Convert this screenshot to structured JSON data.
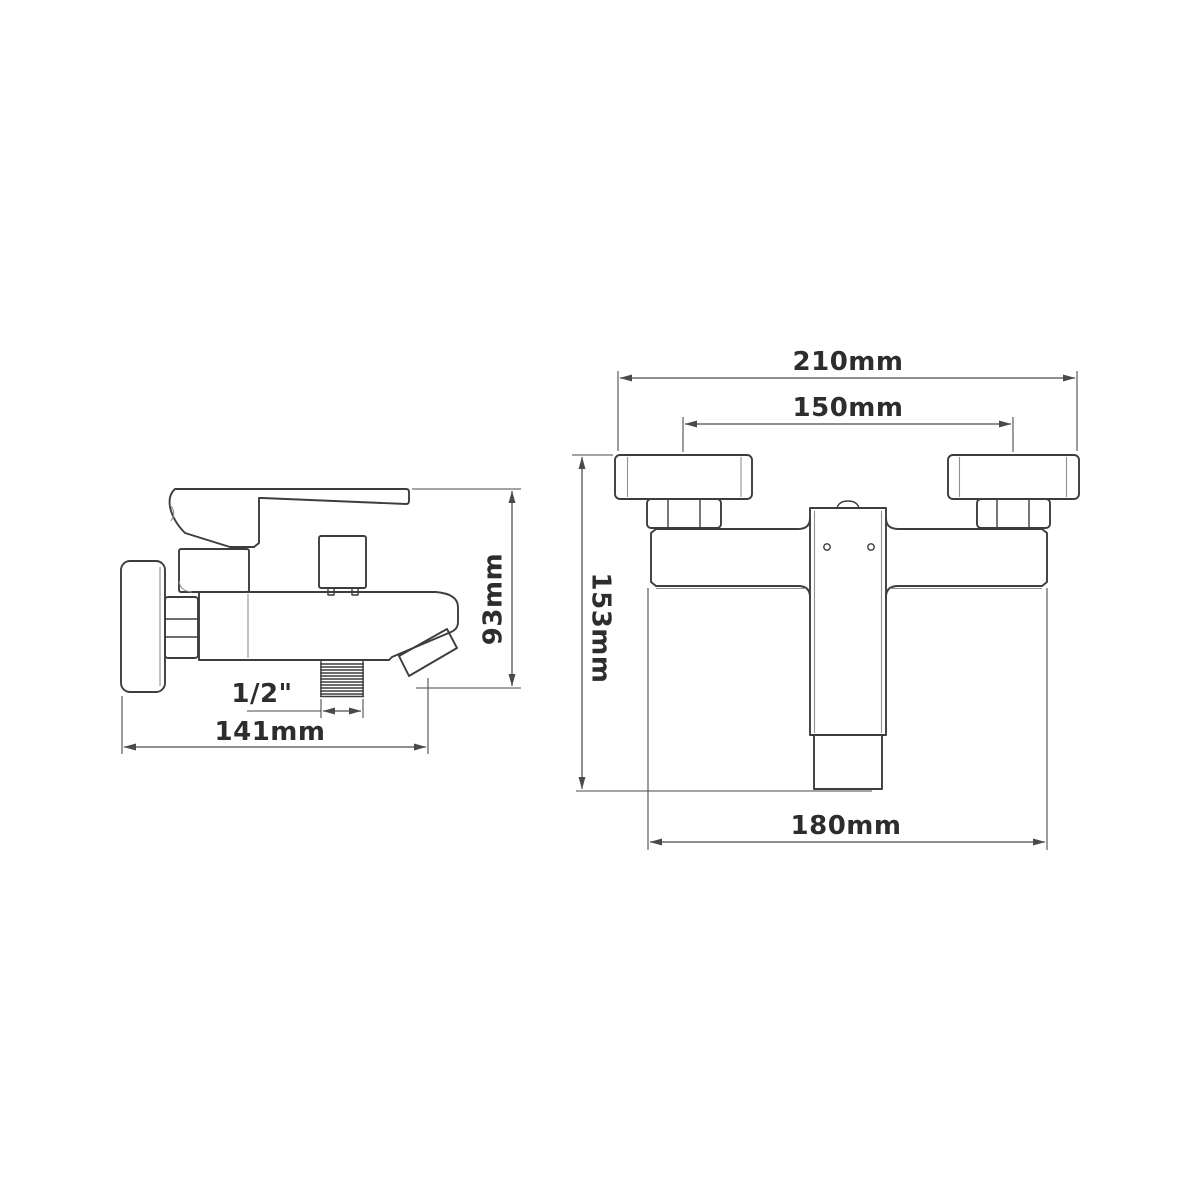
{
  "colors": {
    "background": "#ffffff",
    "part_line": "#3d3d3d",
    "dimension_line": "#4a4a4a",
    "text": "#2d2d2d"
  },
  "side_view": {
    "dims": {
      "height": {
        "label": "93mm"
      },
      "depth": {
        "label": "141mm"
      },
      "thread": {
        "label": "1/2\""
      }
    }
  },
  "front_view": {
    "dims": {
      "overall_width": {
        "label": "210mm"
      },
      "hole_centers": {
        "label": "150mm"
      },
      "height": {
        "label": "153mm"
      },
      "body_width": {
        "label": "180mm"
      }
    }
  }
}
